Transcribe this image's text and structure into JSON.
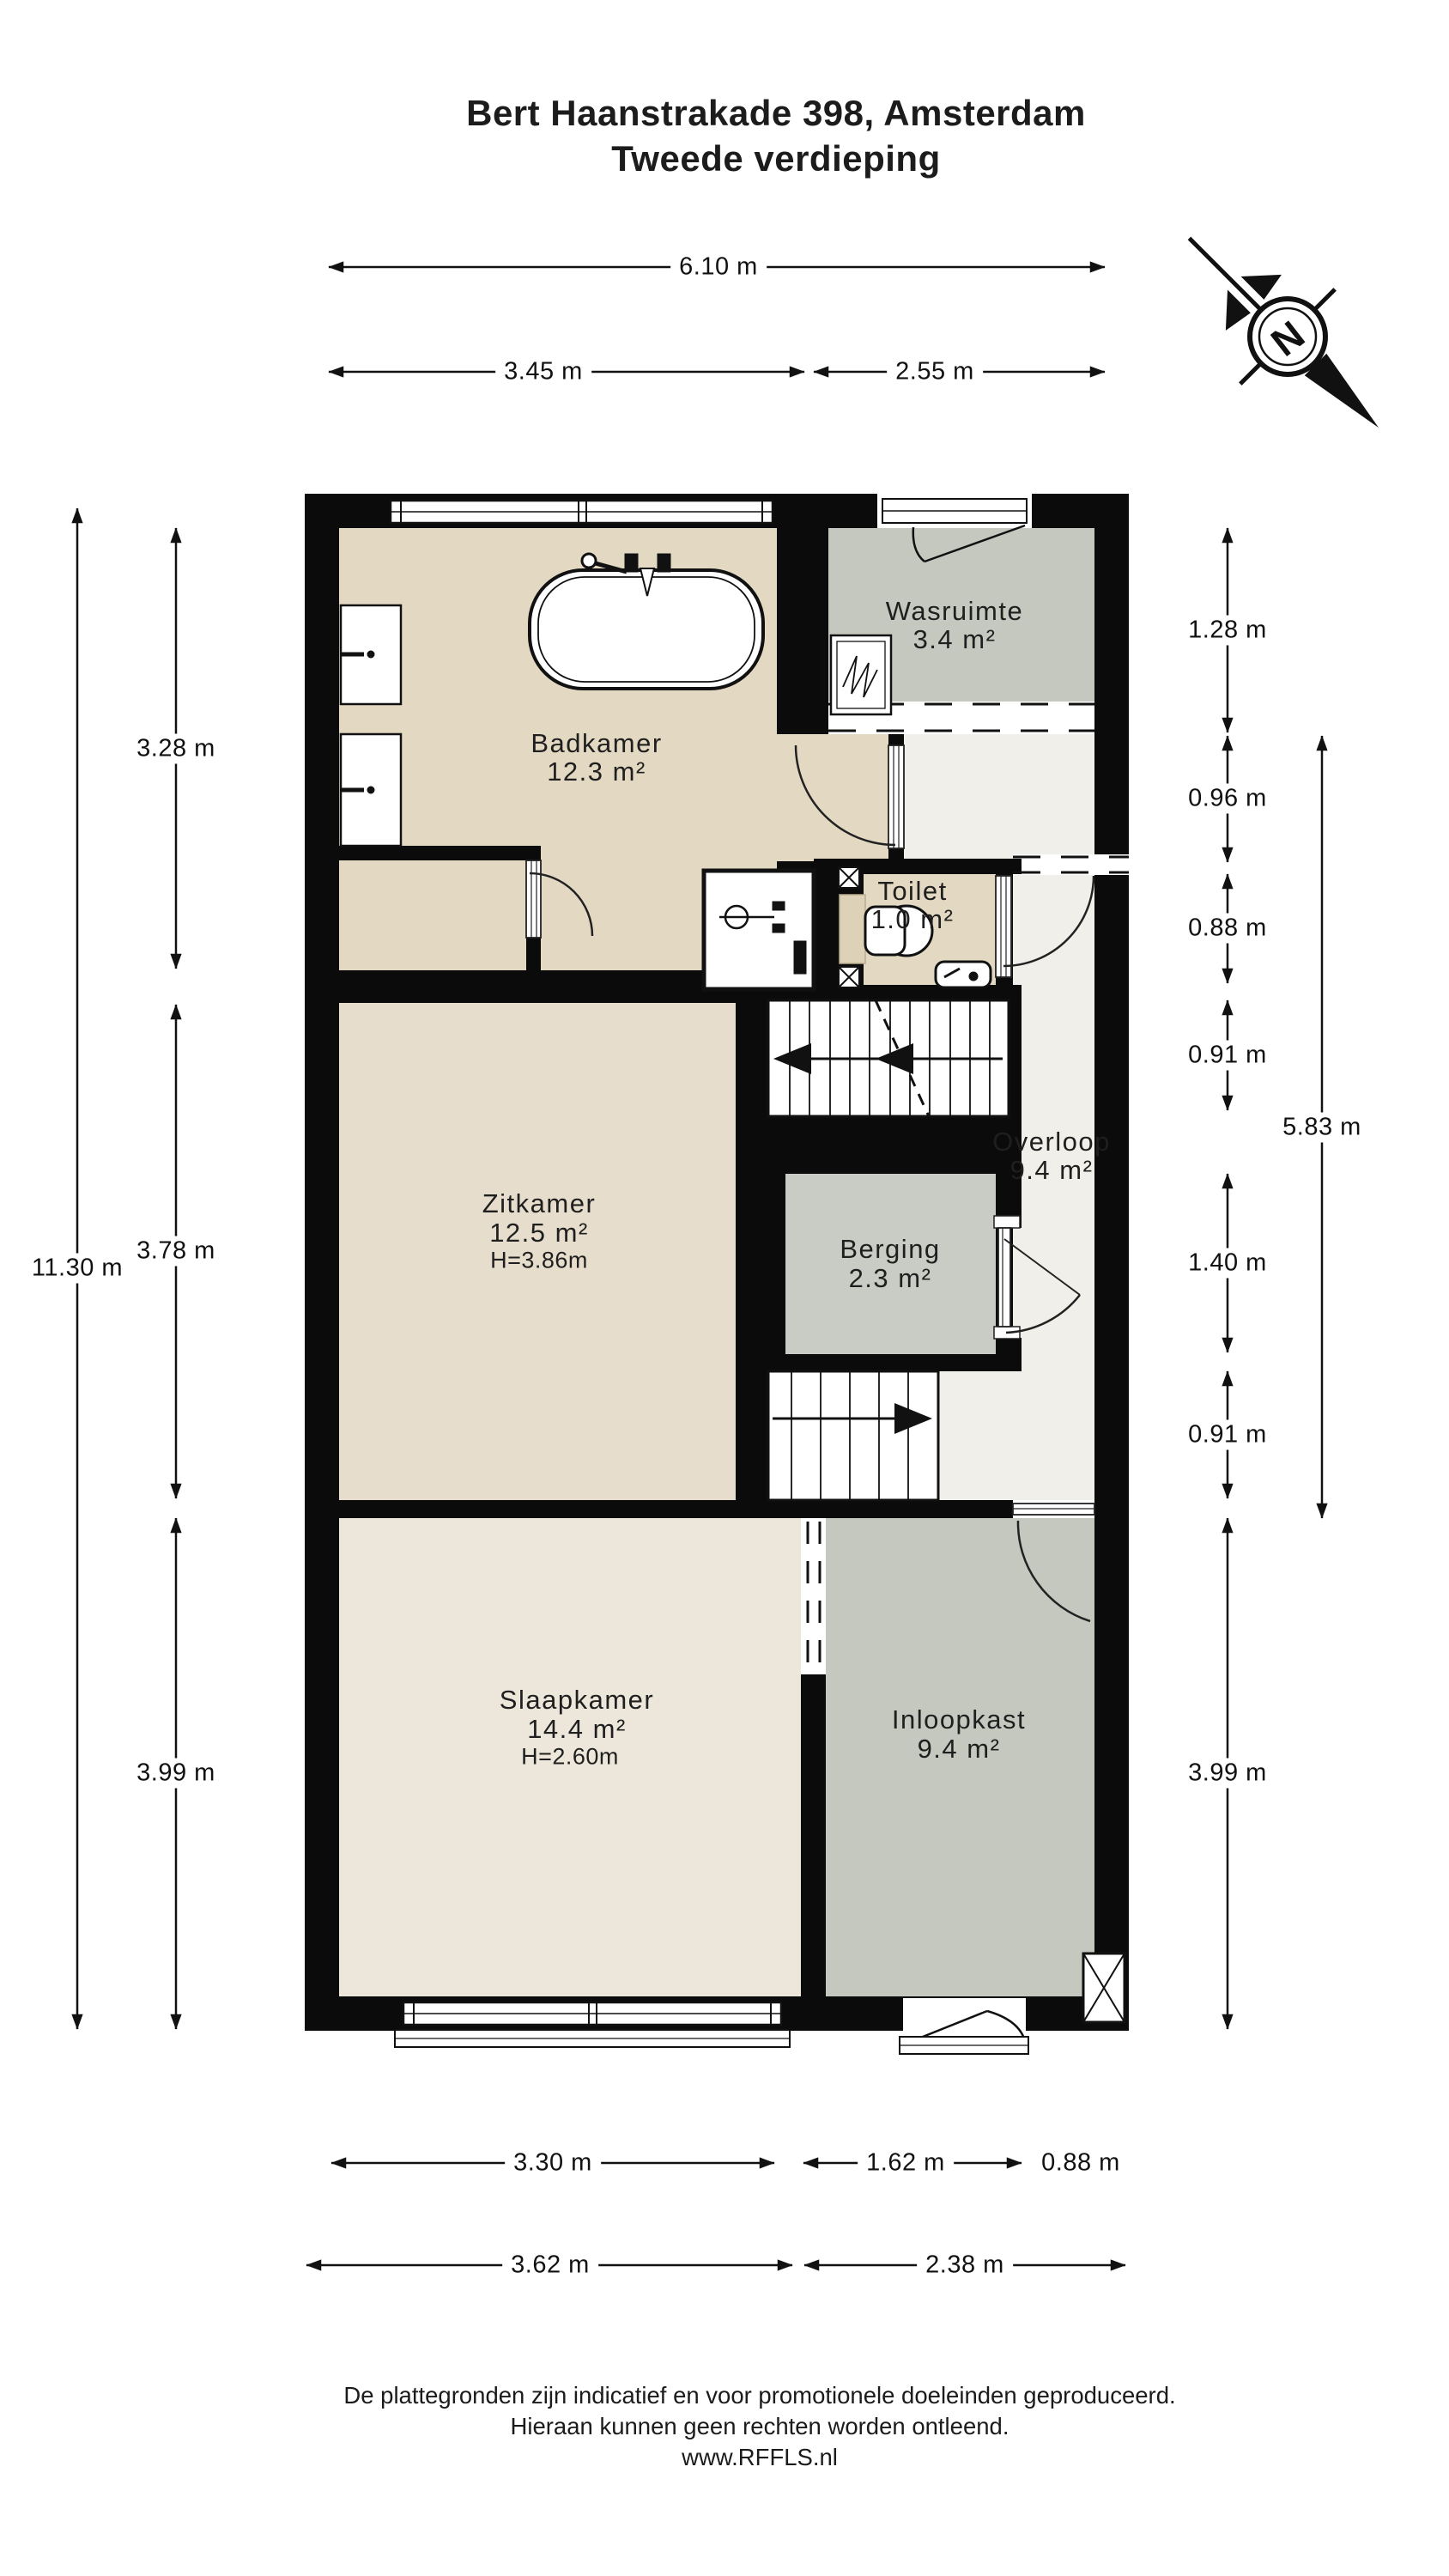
{
  "header": {
    "title_line1": "Bert Haanstrakade 398, Amsterdam",
    "title_line2": "Tweede verdieping"
  },
  "compass": {
    "label": "N"
  },
  "rooms": [
    {
      "id": "badkamer",
      "name": "Badkamer",
      "area": "12.3 m²"
    },
    {
      "id": "wasruimte",
      "name": "Wasruimte",
      "area": "3.4 m²"
    },
    {
      "id": "toilet",
      "name": "Toilet",
      "area": "1.0 m²"
    },
    {
      "id": "zitkamer",
      "name": "Zitkamer",
      "area": "12.5 m²",
      "ceiling_height": "H=3.86m"
    },
    {
      "id": "overloop",
      "name": "Overloop",
      "area": "9.4 m²"
    },
    {
      "id": "berging",
      "name": "Berging",
      "area": "2.3 m²"
    },
    {
      "id": "slaapkamer",
      "name": "Slaapkamer",
      "area": "14.4 m²",
      "ceiling_height": "H=2.60m"
    },
    {
      "id": "inloopkast",
      "name": "Inloopkast",
      "area": "9.4 m²"
    }
  ],
  "dimensions": {
    "top_total": "6.10 m",
    "top_segments": [
      "3.45 m",
      "2.55 m"
    ],
    "left_total": "11.30 m",
    "left_segments": [
      "3.28 m",
      "3.78 m",
      "3.99 m"
    ],
    "right_segments": [
      "1.28 m",
      "0.96 m",
      "0.88 m",
      "0.91 m",
      "1.40 m",
      "0.91 m",
      "3.99 m"
    ],
    "right_total": "5.83 m",
    "bottom_row1": [
      "3.30 m",
      "1.62 m",
      "0.88 m"
    ],
    "bottom_row2": [
      "3.62 m",
      "2.38 m"
    ]
  },
  "footer": {
    "line1": "De plattegronden zijn indicatief en voor promotionele doeleinden geproduceerd.",
    "line2": "Hieraan kunnen geen rechten worden ontleend.",
    "line3": "www.RFFLS.nl"
  },
  "colors": {
    "wall": "#0b0b0b",
    "floor_tan": "#e3d9c3",
    "floor_zitkamer": "#e6ddcc",
    "floor_slaapkamer": "#ece7da",
    "floor_gray": "#c4c8bf",
    "floor_berging": "#c9ccc4",
    "floor_overloop": "#f0efe9"
  }
}
